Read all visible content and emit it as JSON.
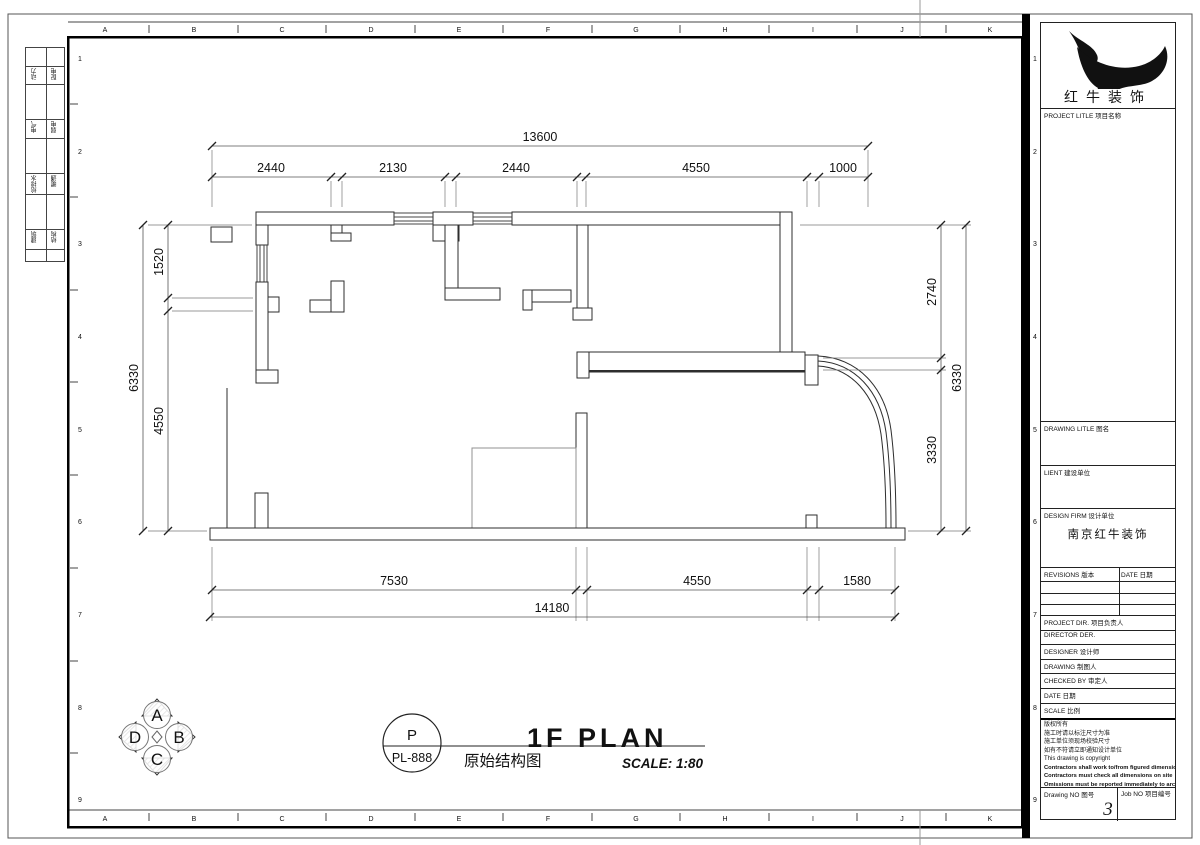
{
  "grid": {
    "letters": [
      "A",
      "B",
      "C",
      "D",
      "E",
      "F",
      "G",
      "H",
      "I",
      "J",
      "K"
    ],
    "numbers": [
      "1",
      "2",
      "3",
      "4",
      "5",
      "6",
      "7",
      "8",
      "9"
    ]
  },
  "disciplines": [
    [
      "动力",
      "配电"
    ],
    [
      "电气",
      "弱电"
    ],
    [
      "给排水",
      "暖通"
    ],
    [
      "建筑",
      "结构"
    ]
  ],
  "dims": {
    "top": {
      "overall": "13600",
      "segments": [
        "2440",
        "2130",
        "2440",
        "4550",
        "1000"
      ]
    },
    "bottom": {
      "overall": "14180",
      "segments": [
        "7530",
        "4550",
        "1580"
      ]
    },
    "left": {
      "overall": "6330",
      "segments": [
        "1520",
        "4550"
      ]
    },
    "right": {
      "overall": "6330",
      "segments": [
        "2740",
        "3330"
      ]
    }
  },
  "compass": {
    "top": "A",
    "right": "B",
    "bottom": "C",
    "left": "D"
  },
  "titlebar": {
    "code_top": "P",
    "code_bottom": "PL-888",
    "cn_title": "原始结构图",
    "main_title": "1F PLAN",
    "scale": "SCALE: 1:80"
  },
  "titleblock": {
    "company": "红牛装饰",
    "project_title": "PROJECT LITLE  项目名称",
    "drawing_title": "DRAWING LITLE  图名",
    "client": "LIENT  建设单位",
    "design_firm": "DESIGN FIRM  设计单位",
    "firm_name": "南京红牛装饰",
    "revisions": "REVISIONS  版本",
    "date_col": "DATE  日期",
    "project_dir": "PROJECT DIR.  项目负责人",
    "director": "DIRECTOR DER.",
    "designer": "DESIGNER  设计师",
    "drawing_by": "DRAWING  制图人",
    "checked_by": "CHECKED BY  审定人",
    "date": "DATE  日期",
    "scale": "SCALE  比例",
    "copyright": [
      "版权所有",
      "施工时请以标注尺寸为准",
      "施工单位须现场校验尺寸",
      "如有不符请立即通知设计单位",
      "This drawing is copyright",
      "Contractors shall work to/from figured dimensions only",
      "Contractors must check all dimensions on site",
      "Omissions must be reported immediately to architects"
    ],
    "drawing_no_label": "Drawing NO  图号",
    "drawing_no": "3",
    "job_no_label": "Job NO  项目编号"
  }
}
